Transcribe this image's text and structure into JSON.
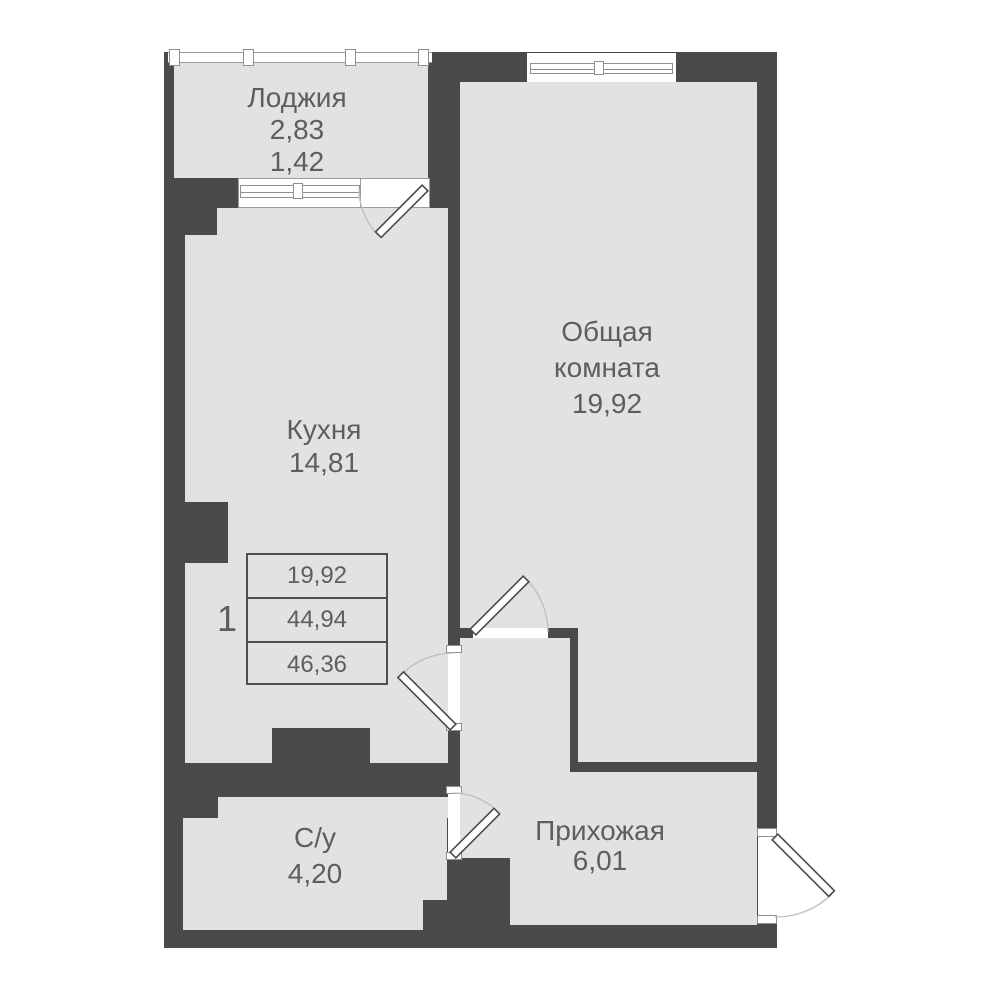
{
  "plan_title": "apartment-floor-plan",
  "rooms": {
    "loggia": {
      "name": "Лоджия",
      "area_top": "2,83",
      "area_bottom": "1,42"
    },
    "kitchen": {
      "name": "Кухня",
      "area": "14,81"
    },
    "living": {
      "name_line1": "Общая",
      "name_line2": "комната",
      "area": "19,92"
    },
    "bathroom": {
      "name": "С/у",
      "area": "4,20"
    },
    "hallway": {
      "name": "Прихожая",
      "area": "6,01"
    }
  },
  "stamp": {
    "apartment_number": "1",
    "values": [
      "19,92",
      "44,94",
      "46,36"
    ]
  },
  "colors": {
    "wall": "#4a4a4a",
    "room_fill": "#e2e2e2",
    "text": "#5e5e5e"
  }
}
